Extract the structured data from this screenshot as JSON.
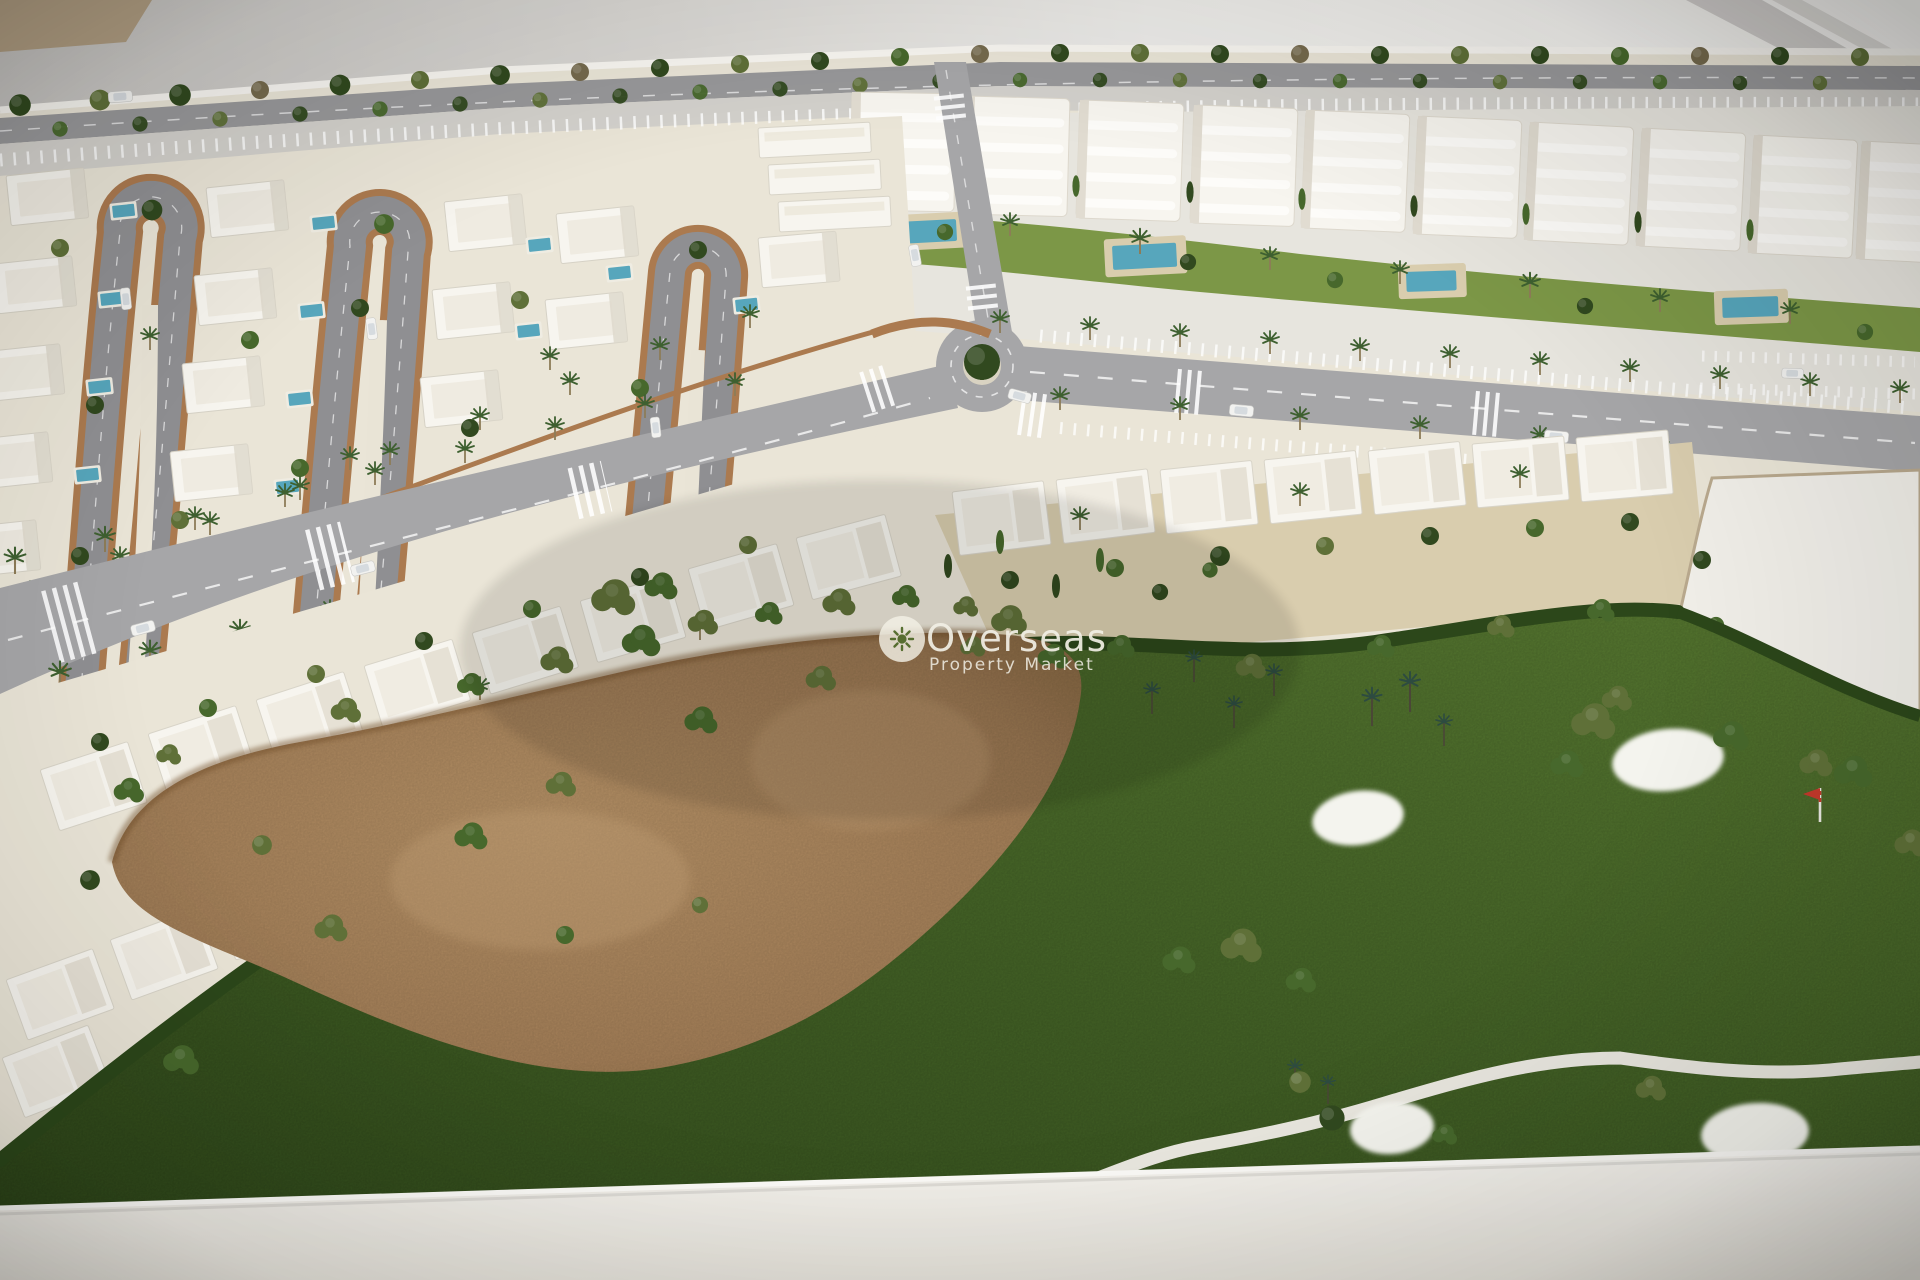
{
  "watermark": {
    "brand": "Overseas",
    "tagline": "Property Market",
    "icon": "sun-icon"
  },
  "scene": {
    "type": "photograph of an architectural scale model (aerial view)",
    "elements": [
      "villa district with hairpin loop streets and private pools",
      "white apartment blocks with communal gardens and pools",
      "tree-lined main avenue with roundabout and crosswalks",
      "curved rows of white townhouses",
      "golf course with waste area, sand bunkers and hole flag",
      "empty white development parcel",
      "white model base platform on grey table"
    ]
  },
  "palette": {
    "bgTan": "#b3a084",
    "bgWall": "#c8c6c3",
    "bgWhite": "#f4f3f0",
    "base": "#efece5",
    "sand": "#eae5d7",
    "tan": "#d9cdae",
    "road": "#98989a",
    "roadL": "#a6a6a8",
    "park": "#d3d1cc",
    "bld": "#f7f5ef",
    "brick": "#ab7a4f",
    "pool": "#57a6bc",
    "lawn1": "#5d8034",
    "lawn2": "#3a5621",
    "dirt": "#b08c62",
    "hedge": "#2c471a",
    "garden": "#7c9747",
    "bunker": "#f4f4ee",
    "flag": "#c4392c",
    "wm": "#f1efe5"
  }
}
